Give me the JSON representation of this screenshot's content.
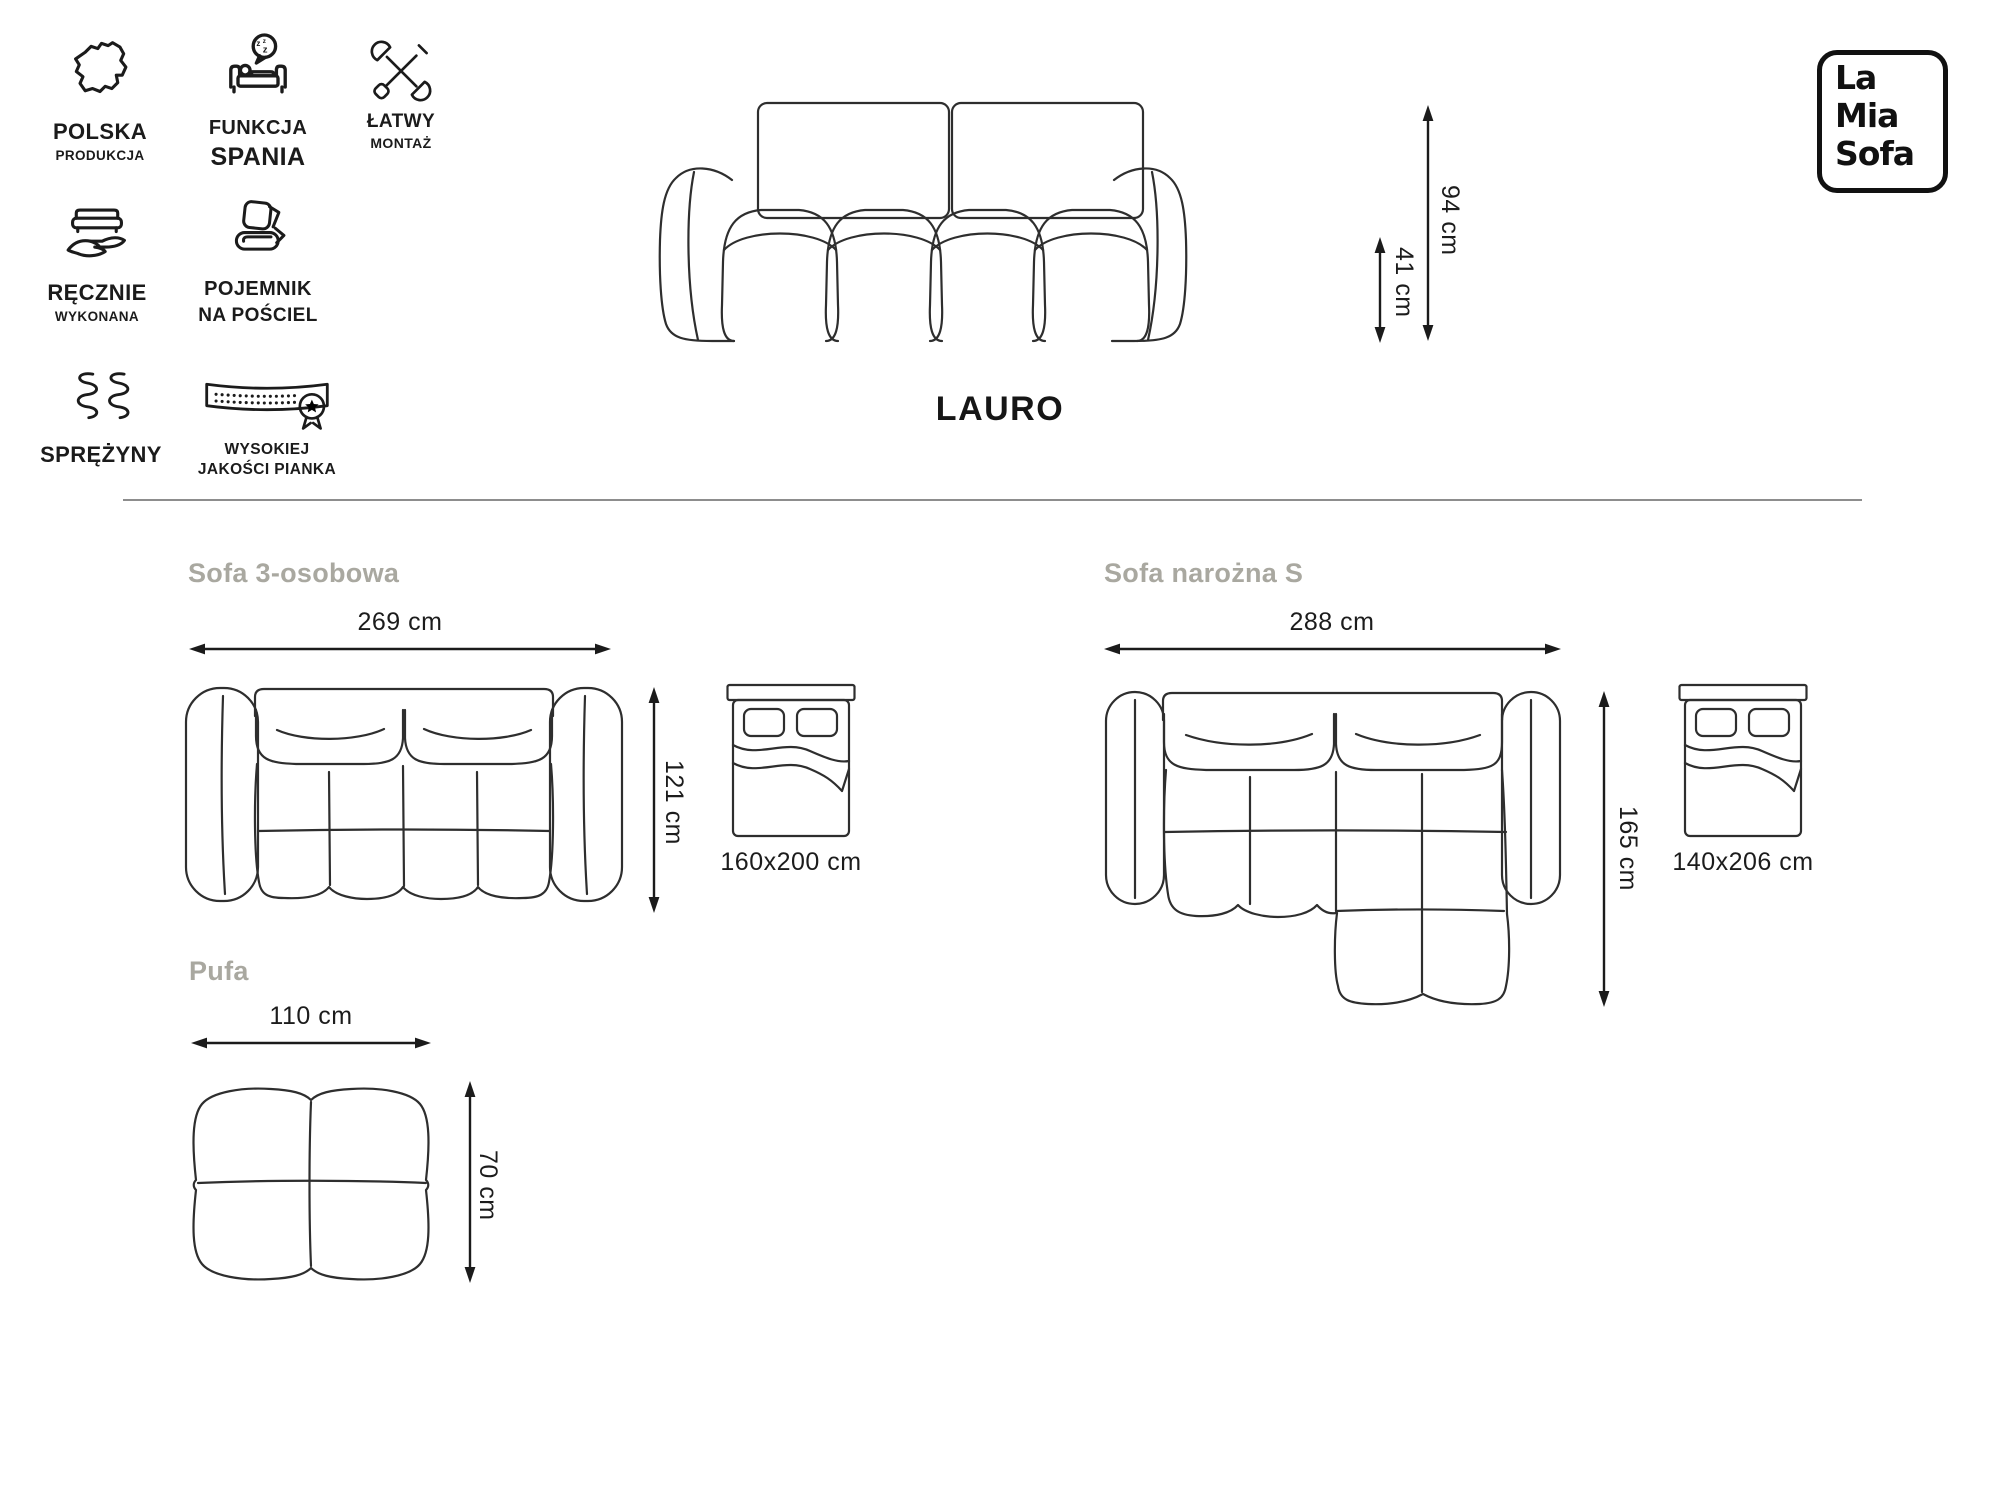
{
  "colors": {
    "ink": "#1b1b1b",
    "heading_gray": "#a9a8a0",
    "drawing_line": "#2e2e2e",
    "divider": "#8d8d8d"
  },
  "logo": {
    "line1": "La",
    "line2": "Mia",
    "line3": "Sofa"
  },
  "title": "LAURO",
  "features": {
    "produkcja": {
      "line1": "POLSKA",
      "line2": "PRODUKCJA"
    },
    "spanie": {
      "line1": "FUNKCJA",
      "line2": "SPANIA"
    },
    "montaz": {
      "line1": "ŁATWY",
      "line2": "MONTAŻ"
    },
    "recznie": {
      "line1": "RĘCZNIE",
      "line2": "WYKONANA"
    },
    "pojemnik": {
      "line1": "POJEMNIK",
      "line2": "NA POŚCIEL"
    },
    "sprezyny": {
      "line1": "SPRĘŻYNY"
    },
    "pianka": {
      "line1": "WYSOKIEJ",
      "line2": "JAKOŚCI PIANKA"
    }
  },
  "front": {
    "height": "94 cm",
    "seat_height": "41 cm"
  },
  "variants": {
    "sofa3": {
      "name": "Sofa 3-osobowa",
      "width": "269 cm",
      "depth": "121 cm",
      "bed_size": "160x200 cm"
    },
    "narozna": {
      "name": "Sofa narożna S",
      "width": "288 cm",
      "depth": "165 cm",
      "bed_size": "140x206 cm"
    },
    "pufa": {
      "name": "Pufa",
      "width": "110 cm",
      "depth": "70 cm"
    }
  }
}
